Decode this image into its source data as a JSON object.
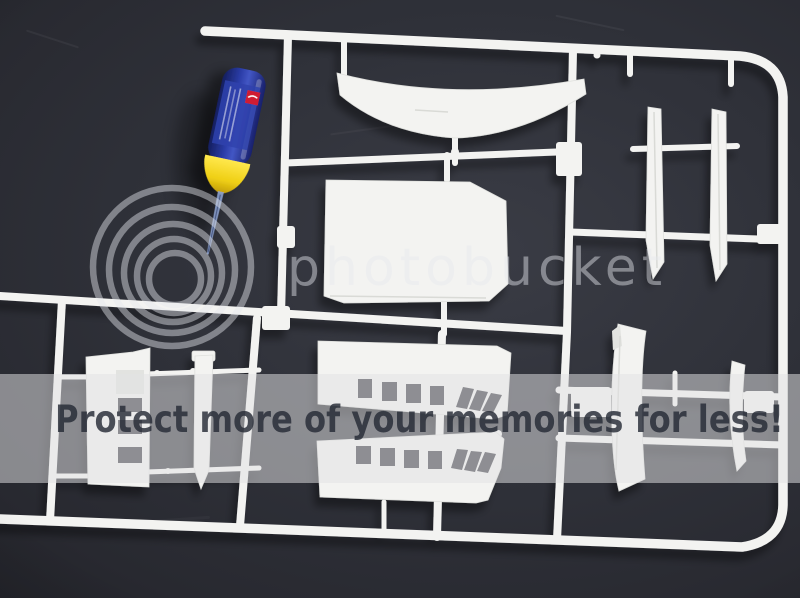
{
  "watermark": {
    "brand": "photobucket",
    "banner": "Protect more of your memories for less!",
    "logo_icon": "concentric-rings",
    "color": "#e6e8ee",
    "banner_bg": "#e2e2e4",
    "banner_text_color": "#262b36"
  },
  "scene": {
    "alt": "white plastic model-kit sprue with ship parts and a blue glue bottle with yellow tip on a dark surface",
    "colors": {
      "background": "#2c2e36",
      "plastic": "#f3f3f1",
      "bottle_body": "#2b3da8",
      "bottle_tip": "#f0d020",
      "bottle_logo": "#cf1f30",
      "needle": "#8ba0cc"
    }
  }
}
